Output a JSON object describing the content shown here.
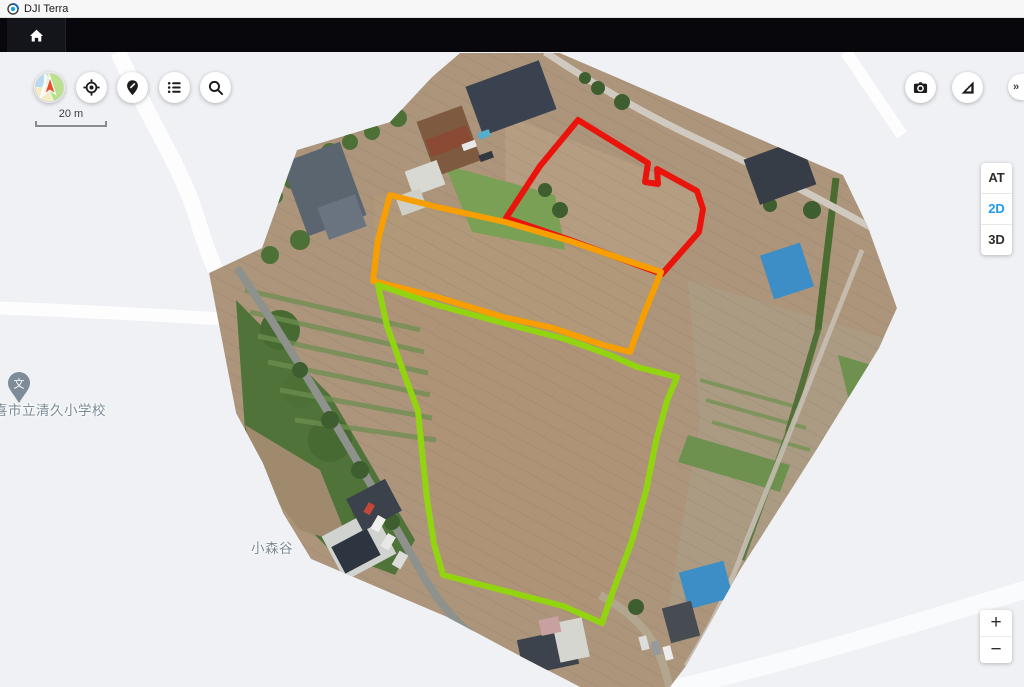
{
  "window": {
    "title": "DJI Terra"
  },
  "map_controls": {
    "scale_label": "20 m",
    "expand_label": "»",
    "zoom_in_label": "+",
    "zoom_out_label": "−",
    "view_modes": [
      {
        "label": "AT",
        "active": false
      },
      {
        "label": "2D",
        "active": true
      },
      {
        "label": "3D",
        "active": false
      }
    ],
    "icons": {
      "left_toolbar": [
        "basemap-icon",
        "locate-icon",
        "marker-icon",
        "list-icon",
        "search-icon"
      ],
      "right_toolbar": [
        "camera-icon",
        "measure-icon"
      ],
      "navbar": [
        "home-icon"
      ]
    }
  },
  "map_labels": [
    {
      "text": "喜市立清久小学校"
    },
    {
      "text": "小森谷"
    }
  ],
  "colors": {
    "active_mode_blue": "#1f9bef",
    "basemap_background": "#eff1f4",
    "label_gray_blue": "#7b8b97",
    "annotation_red": "#ea140c",
    "annotation_orange": "#f79e00",
    "annotation_green": "#93d410"
  },
  "annotations": {
    "polygons": [
      {
        "name": "field-red",
        "color": "#ea140c",
        "points": [
          [
            578,
            120
          ],
          [
            648,
            163
          ],
          [
            645,
            182
          ],
          [
            658,
            184
          ],
          [
            657,
            169
          ],
          [
            697,
            191
          ],
          [
            703,
            209
          ],
          [
            699,
            232
          ],
          [
            662,
            274
          ],
          [
            570,
            240
          ],
          [
            506,
            218
          ],
          [
            540,
            166
          ]
        ]
      },
      {
        "name": "field-orange",
        "color": "#f79e00",
        "points": [
          [
            390,
            195
          ],
          [
            437,
            207
          ],
          [
            505,
            222
          ],
          [
            570,
            241
          ],
          [
            625,
            260
          ],
          [
            661,
            272
          ],
          [
            644,
            314
          ],
          [
            630,
            352
          ],
          [
            603,
            345
          ],
          [
            553,
            328
          ],
          [
            503,
            317
          ],
          [
            437,
            297
          ],
          [
            373,
            281
          ],
          [
            378,
            240
          ]
        ]
      },
      {
        "name": "field-green",
        "color": "#93d410",
        "points": [
          [
            378,
            285
          ],
          [
            437,
            305
          ],
          [
            503,
            323
          ],
          [
            565,
            339
          ],
          [
            610,
            355
          ],
          [
            637,
            367
          ],
          [
            677,
            377
          ],
          [
            667,
            401
          ],
          [
            656,
            441
          ],
          [
            646,
            491
          ],
          [
            632,
            541
          ],
          [
            612,
            594
          ],
          [
            602,
            623
          ],
          [
            563,
            606
          ],
          [
            513,
            593
          ],
          [
            443,
            575
          ],
          [
            434,
            544
          ],
          [
            427,
            499
          ],
          [
            423,
            461
          ],
          [
            418,
            411
          ],
          [
            406,
            379
          ],
          [
            387,
            326
          ]
        ]
      }
    ]
  }
}
